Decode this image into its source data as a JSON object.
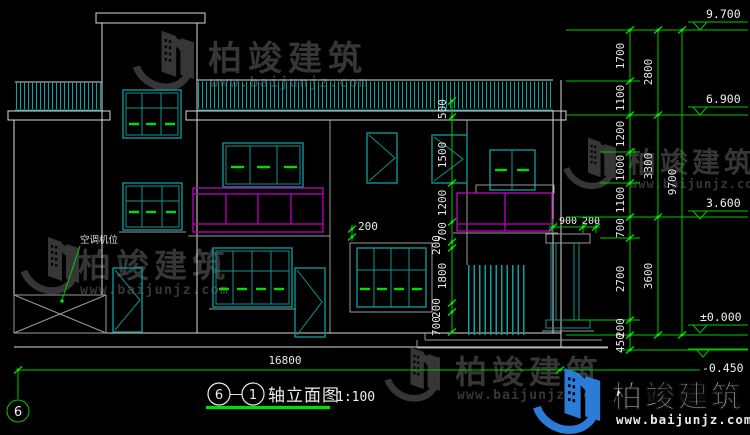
{
  "drawing": {
    "title": {
      "bubble_left": "6",
      "separator": "—",
      "bubble_right": "1",
      "text": "轴立面图",
      "scale": "1:100"
    },
    "axis_bubble": "6",
    "ac_label": "空调机位",
    "elevation_markers": [
      "9.700",
      "6.900",
      "3.600",
      "±0.000",
      "-0.450"
    ],
    "dims": {
      "overall_width": "16800",
      "right_inner": [
        "1700",
        "1100",
        "1200",
        "1000",
        "1100",
        "700",
        "2700",
        "200",
        "450"
      ],
      "right_mid": [
        "2800",
        "3300",
        "3600"
      ],
      "right_outer": "9700",
      "facade": [
        "500",
        "1500",
        "1200",
        "700",
        "200",
        "1800",
        "200",
        "700"
      ],
      "eave_offset": "200",
      "porch": [
        "900",
        "200"
      ]
    }
  },
  "watermark": {
    "brand": "柏竣建筑",
    "url": "www.baijunjz.com",
    "gray_color": "#3b3b3b",
    "blue_color": "#2b7cd8"
  },
  "colors": {
    "background": "#000000",
    "window_teal": "#0d9595",
    "dimension_green": "#00c800",
    "balcony_magenta": "#c400c4",
    "wall_white": "#d9d9d9"
  }
}
